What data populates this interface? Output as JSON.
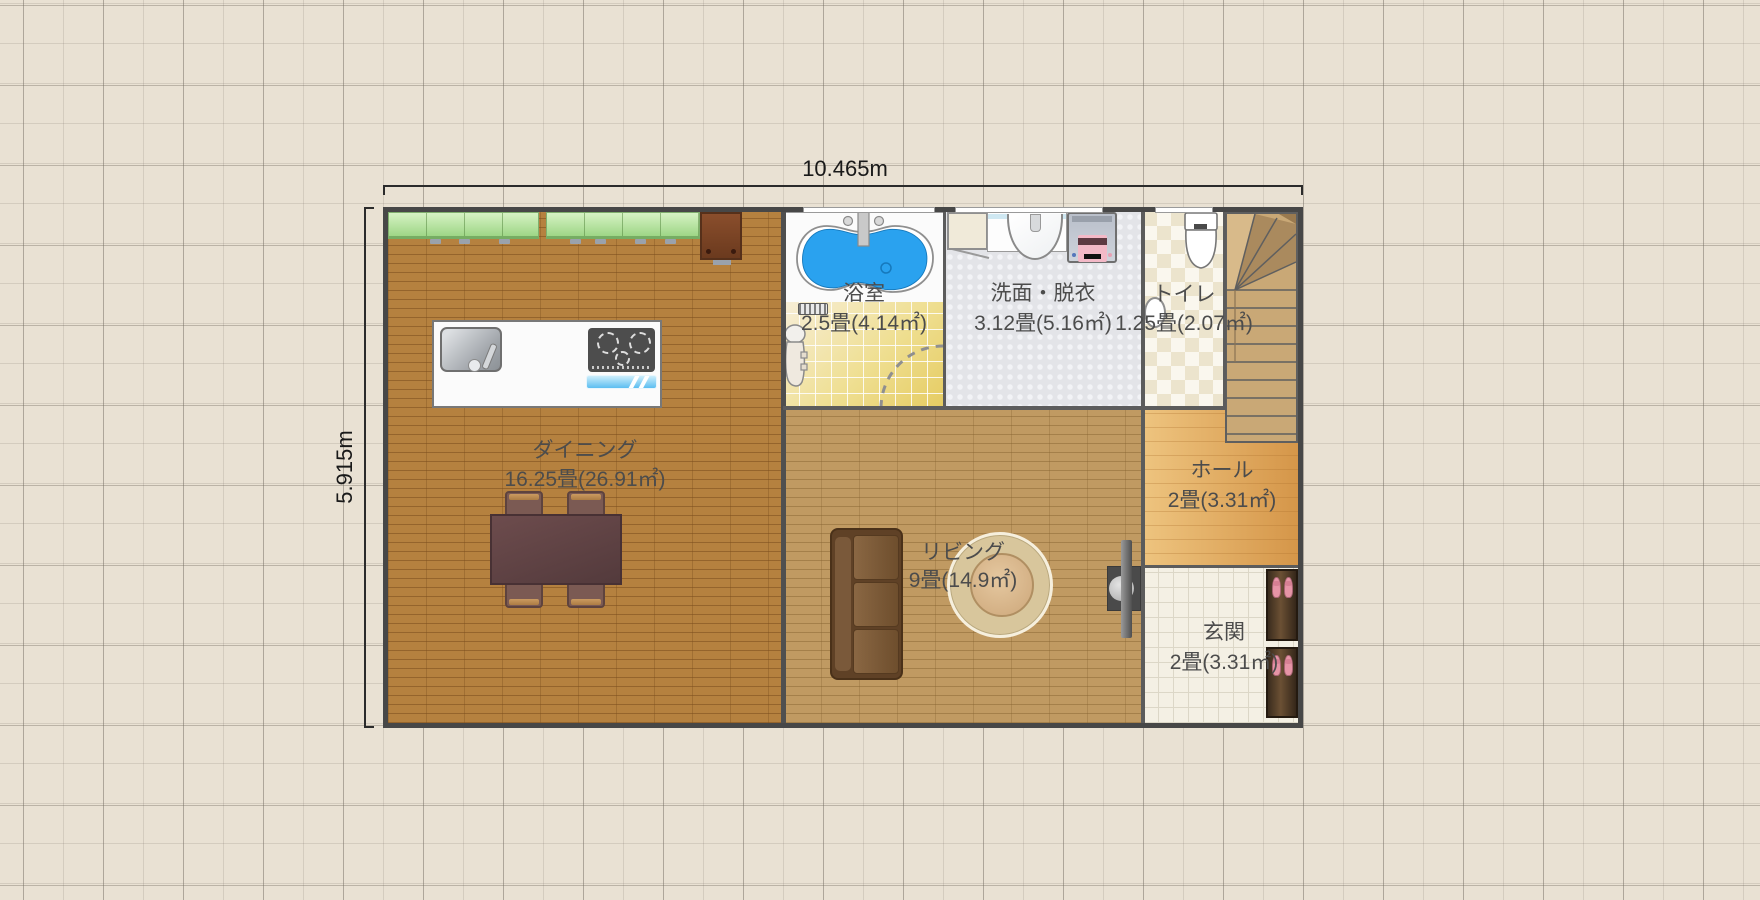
{
  "plan": {
    "dimensions": {
      "width_label": "10.465m",
      "height_label": "5.915m"
    },
    "rooms": [
      {
        "id": "dining",
        "name": "ダイニング",
        "area": "16.25畳(26.91㎡)"
      },
      {
        "id": "bathroom",
        "name": "浴室",
        "area": "2.5畳(4.14㎡)"
      },
      {
        "id": "washroom",
        "name": "洗面・脱衣",
        "area": "3.12畳(5.16㎡)"
      },
      {
        "id": "toilet",
        "name": "トイレ",
        "area": "1.25畳(2.07㎡)"
      },
      {
        "id": "hall",
        "name": "ホール",
        "area": "2畳(3.31㎡)"
      },
      {
        "id": "living",
        "name": "リビング",
        "area": "9畳(14.9㎡)"
      },
      {
        "id": "entrance",
        "name": "玄関",
        "area": "2畳(3.31㎡)"
      }
    ],
    "furniture": [
      "kitchen-wall-cabinets",
      "refrigerator",
      "kitchen-island",
      "kitchen-sink",
      "gas-stove",
      "dining-table",
      "dining-chairs",
      "bathtub",
      "bath-faucet",
      "bath-mat",
      "shower-unit",
      "bath-door-swing",
      "vanity-sink",
      "washing-machine",
      "toilet-fixture",
      "corner-hand-basin",
      "staircase",
      "sofa",
      "round-rug",
      "living-hall-door",
      "shoe-cabinet",
      "slippers"
    ],
    "colors": {
      "background": "#e9e1d3",
      "wall": "#474747",
      "dining_floor": "#b5813f",
      "living_floor": "#c09a62",
      "bath_tile": "#efdf92",
      "washroom_floor": "#e3e4e8",
      "toilet_floor": "#f4efdf",
      "hall_floor": "#e3ab5e",
      "entrance_tile": "#f4f0e4",
      "cabinet_green": "#b4e29c",
      "bathtub_blue": "#2aa2ef",
      "slipper_pink": "#e694a6",
      "stair_wood": "#c9a876"
    }
  }
}
